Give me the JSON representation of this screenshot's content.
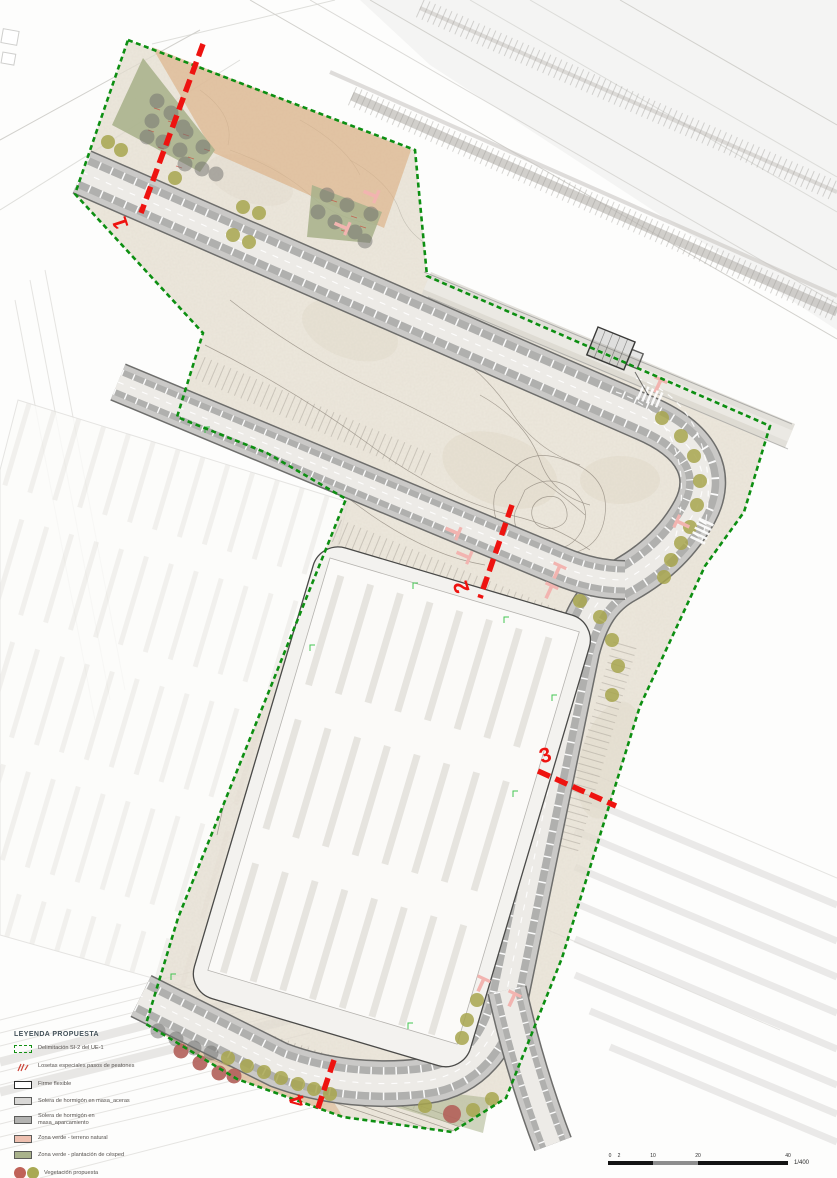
{
  "legend": {
    "title": "LEYENDA PROPUESTA",
    "items": [
      {
        "label": "Delimitación SI-2 del UE-1",
        "swatch": "dashed-outline",
        "color": "#149114"
      },
      {
        "label": "Losetas especiales pasos de peatones",
        "swatch": "symbol",
        "color": "#cc4338"
      },
      {
        "label": "Firme flexible",
        "swatch": "box",
        "color": "#ffffff"
      },
      {
        "label": "Solera de hormigón en masa_aceras",
        "swatch": "box",
        "color": "#d9d8d6"
      },
      {
        "label": "Solera de hormigón en masa_aparcamiento",
        "swatch": "box",
        "color": "#b3b3b1"
      },
      {
        "label": "Zona verde - terreno natural",
        "swatch": "box",
        "color": "#eec0b0"
      },
      {
        "label": "Zona verde - plantación de césped",
        "swatch": "box",
        "color": "#a9b28b"
      },
      {
        "label": "Vegetación propuesta",
        "swatch": "circles",
        "colors": [
          "#c06258",
          "#a9a953"
        ]
      }
    ]
  },
  "sections": [
    {
      "number": "1"
    },
    {
      "number": "2"
    },
    {
      "number": "3"
    },
    {
      "number": "4"
    }
  ],
  "scale_bar": {
    "ticks": [
      "0",
      "2",
      "10",
      "20",
      "40"
    ],
    "ratio": "1/400"
  },
  "colors": {
    "boundary_green": "#0d8f12",
    "section_red": "#ee1310",
    "terrain": "#e7e0d3",
    "orange_zone": "#dcae81",
    "grass_zone": "#a9b28b",
    "tree_gray": "#70706e",
    "veg_olive": "#a8a64f",
    "veg_red": "#b2605a",
    "crosswalk_pink": "#f2b4b0",
    "road_parking": "#b0b0ae",
    "road_sidewalk": "#cac9c7",
    "road_surface": "#edebe7"
  }
}
